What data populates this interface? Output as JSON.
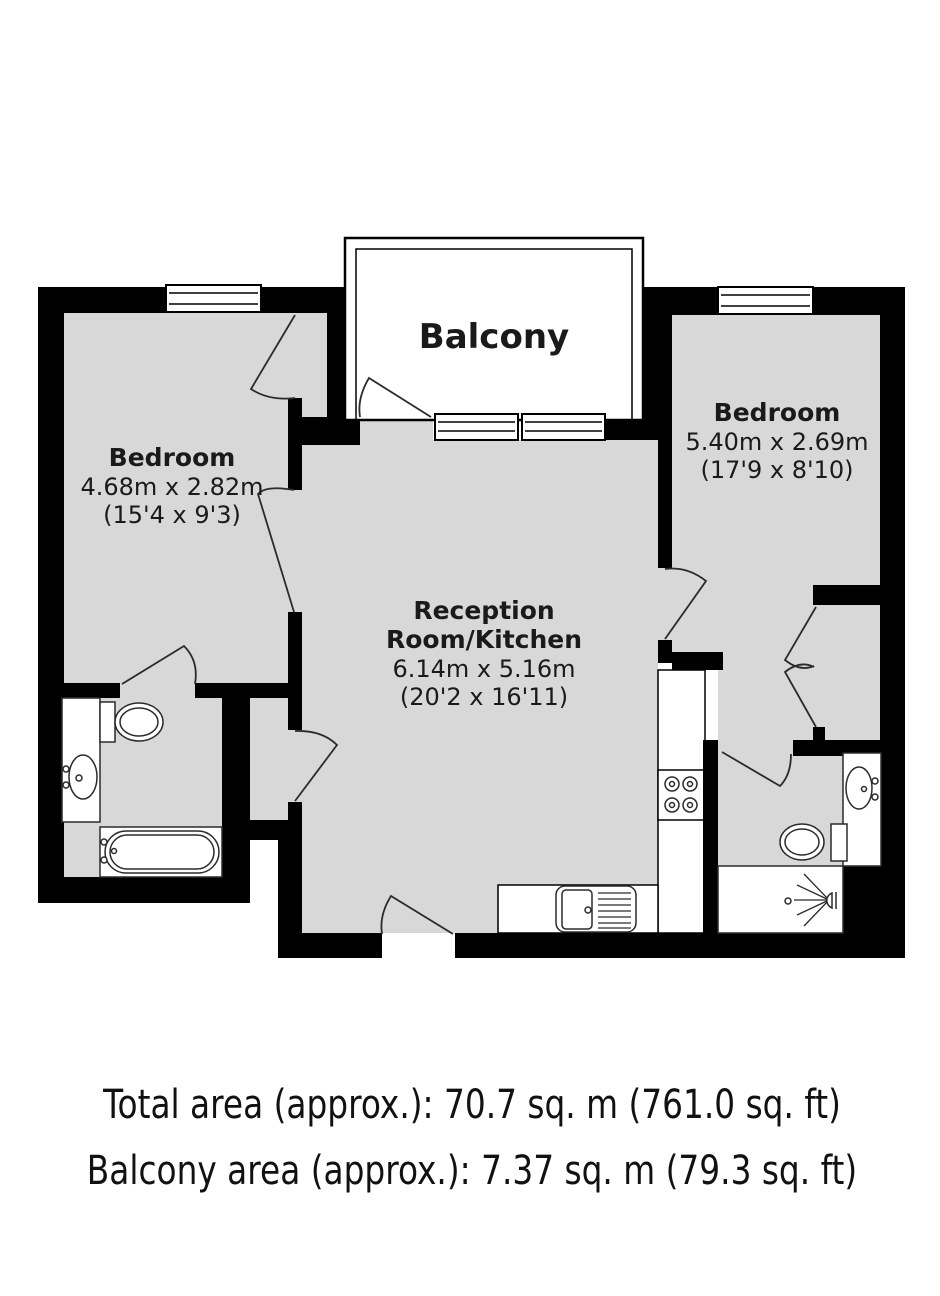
{
  "plan": {
    "balcony": {
      "label": "Balcony"
    },
    "bedroom_left": {
      "label": "Bedroom",
      "size_metric": "4.68m x 2.82m",
      "size_imperial": "(15'4 x 9'3)"
    },
    "bedroom_right": {
      "label": "Bedroom",
      "size_metric": "5.40m x 2.69m",
      "size_imperial": "(17'9 x 8'10)"
    },
    "reception": {
      "label_line1": "Reception",
      "label_line2": "Room/Kitchen",
      "size_metric": "6.14m x 5.16m",
      "size_imperial": "(20'2 x 16'11)"
    }
  },
  "footer": {
    "total_area": "Total area (approx.): 70.7 sq. m (761.0 sq. ft)",
    "balcony_area": "Balcony area (approx.): 7.37 sq. m (79.3 sq. ft)"
  },
  "colors": {
    "wall": "#000000",
    "floor": "#d8d8d8",
    "fixture_fill": "#ffffff",
    "outline": "#2b2b2b",
    "text": "#1a1a1a"
  },
  "fixtures": {
    "left_bathroom": [
      "toilet",
      "sink",
      "bathtub"
    ],
    "right_bathroom": [
      "sink",
      "toilet",
      "shower"
    ],
    "kitchen": [
      "hob",
      "sink-drainer"
    ],
    "windows": 4,
    "doors": 10
  }
}
